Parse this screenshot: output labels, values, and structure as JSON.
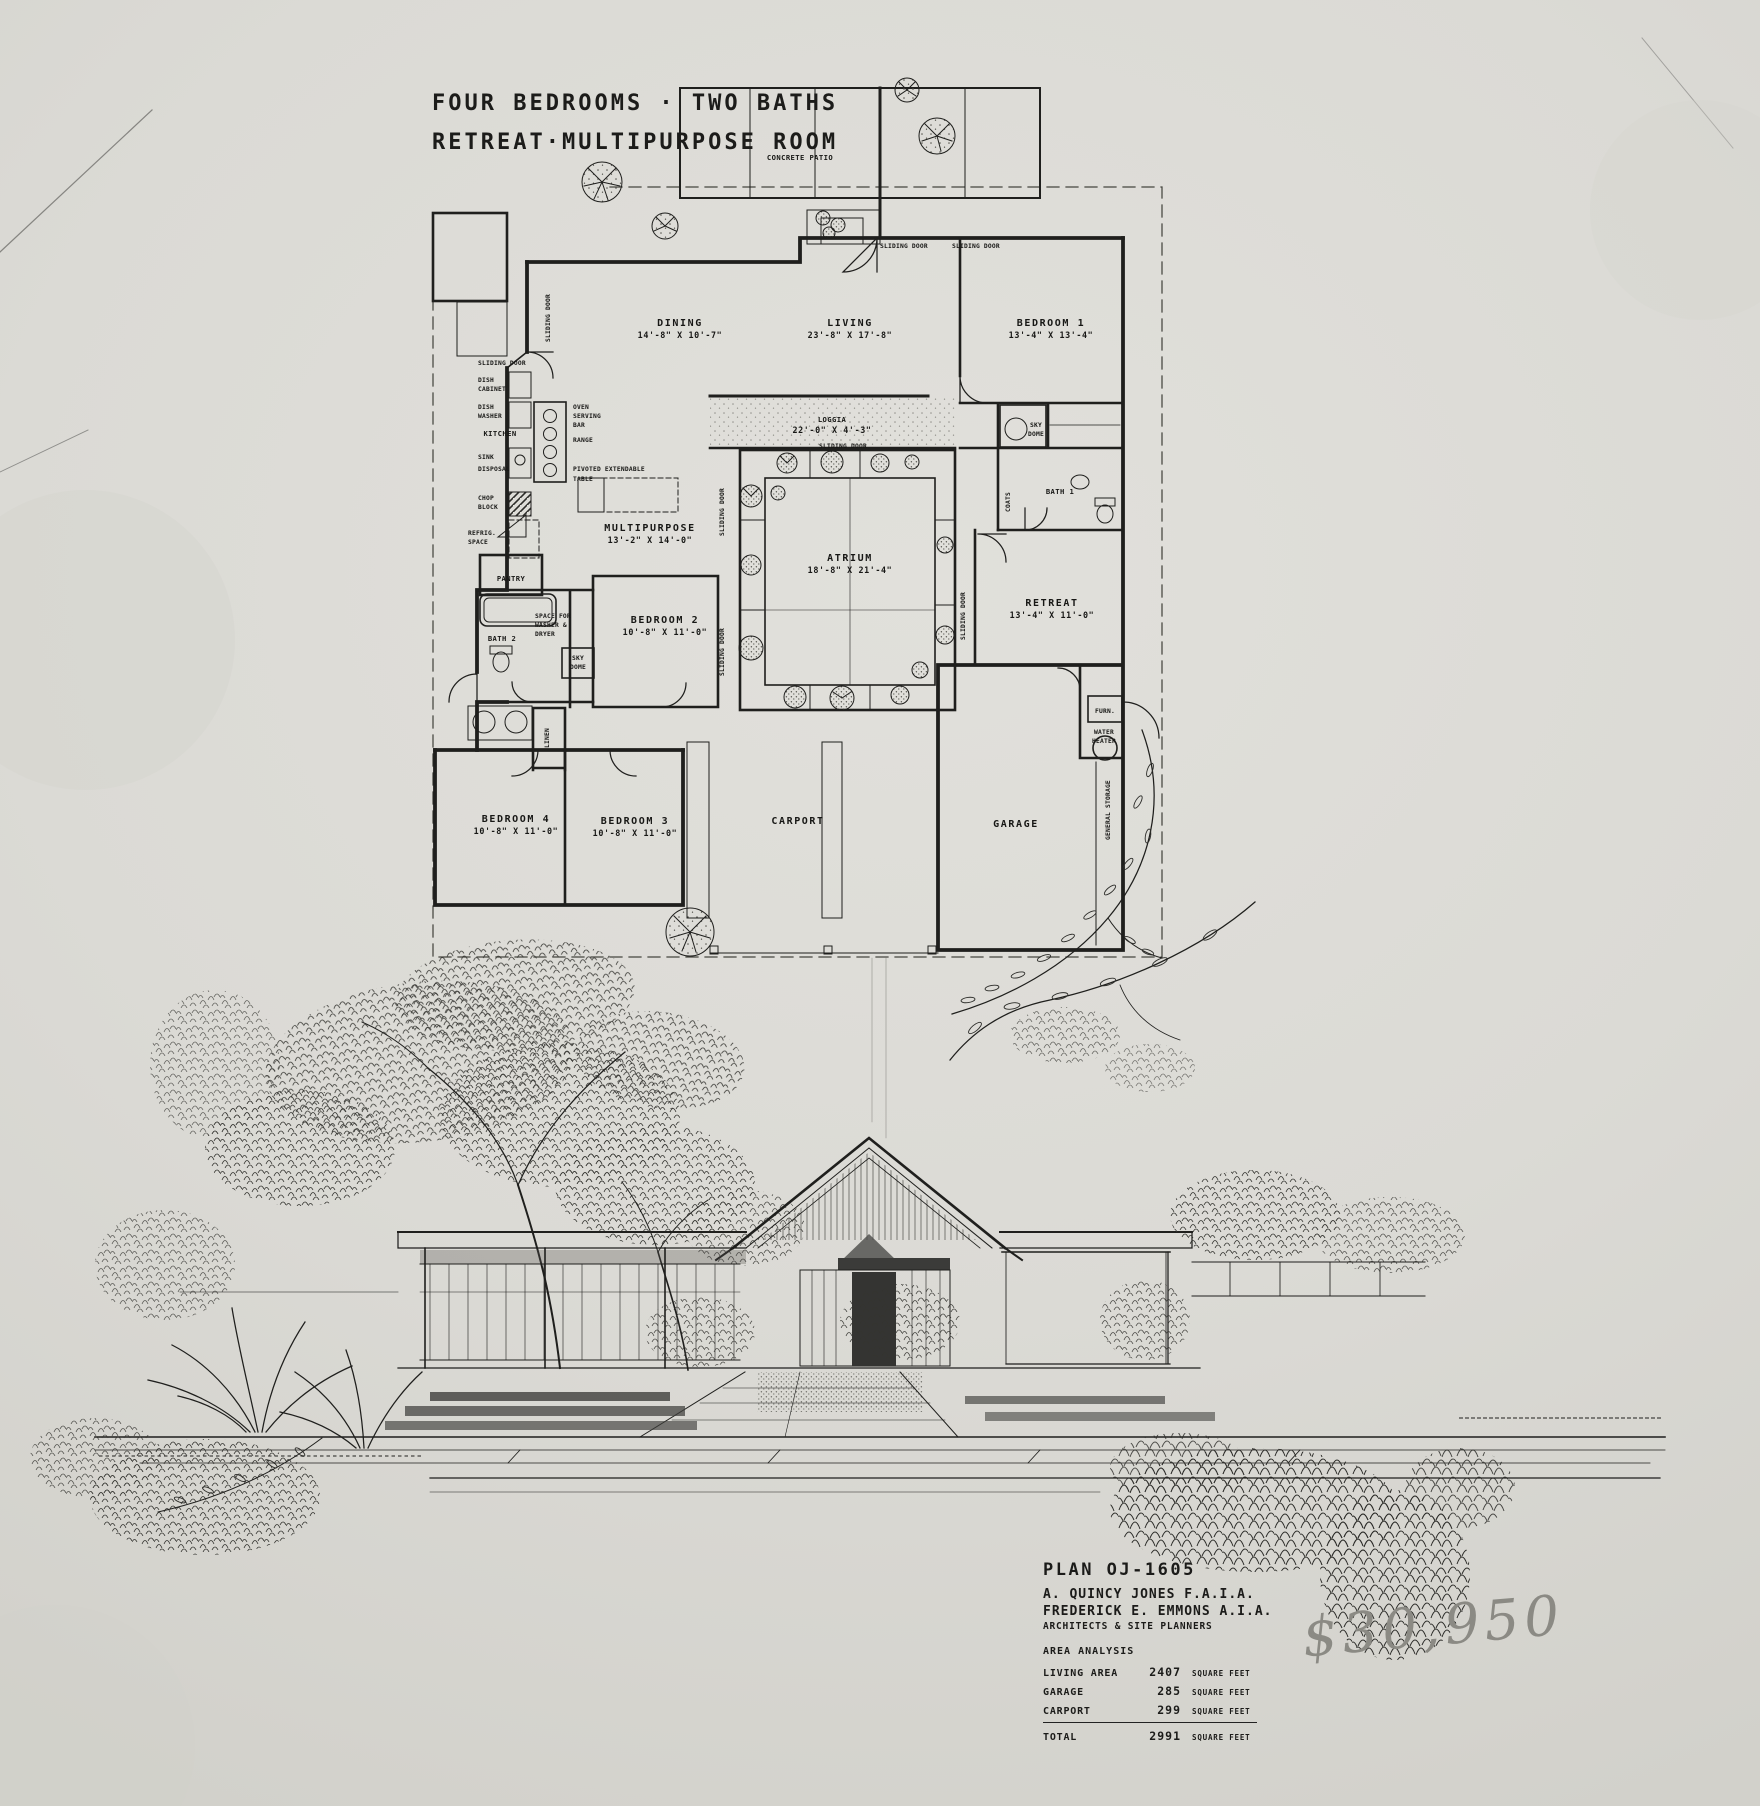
{
  "sheet": {
    "title_line1": "FOUR BEDROOMS · TWO BATHS",
    "title_line2": "RETREAT·MULTIPURPOSE ROOM",
    "handwritten_price": "$30,950",
    "paper_color": "#dbdad5",
    "ink_color": "#1f1f1d",
    "pencil_color": "#8b8a84"
  },
  "plan": {
    "patio_label": "CONCRETE PATIO",
    "rooms": {
      "dining": {
        "name": "DINING",
        "dims": "14'-8\" X 10'-7\""
      },
      "living": {
        "name": "LIVING",
        "dims": "23'-8\" X 17'-8\""
      },
      "bedroom1": {
        "name": "BEDROOM 1",
        "dims": "13'-4\" X 13'-4\""
      },
      "loggia": {
        "name": "LOGGIA",
        "dims": "22'-0\" X 4'-3\""
      },
      "multipurpose": {
        "name": "MULTIPURPOSE",
        "dims": "13'-2\" X 14'-0\""
      },
      "atrium": {
        "name": "ATRIUM",
        "dims": "18'-8\" X 21'-4\""
      },
      "retreat": {
        "name": "RETREAT",
        "dims": "13'-4\" X 11'-0\""
      },
      "bedroom2": {
        "name": "BEDROOM 2",
        "dims": "10'-8\" X 11'-0\""
      },
      "bedroom3": {
        "name": "BEDROOM 3",
        "dims": "10'-8\" X 11'-0\""
      },
      "bedroom4": {
        "name": "BEDROOM 4",
        "dims": "10'-8\" X 11'-0\""
      },
      "carport": {
        "name": "CARPORT"
      },
      "garage": {
        "name": "GARAGE"
      },
      "bath1": {
        "name": "BATH 1"
      },
      "bath2": {
        "name": "BATH 2"
      },
      "kitchen": {
        "name": "KITCHEN"
      }
    },
    "labels": {
      "sliding_door": "SLIDING DOOR",
      "dish_cabinet": [
        "DISH",
        "CABINET"
      ],
      "dish_washer": [
        "DISH",
        "WASHER"
      ],
      "sink": "SINK",
      "disposal": "DISPOSAL",
      "chop_block": [
        "CHOP",
        "BLOCK"
      ],
      "refrig_space": [
        "REFRIG.",
        "SPACE"
      ],
      "oven_serving_bar": [
        "OVEN",
        "SERVING",
        "BAR"
      ],
      "range": "RANGE",
      "pivoted_table": [
        "PIVOTED EXTENDABLE",
        "TABLE"
      ],
      "pantry": "PANTRY",
      "washer_dryer": [
        "SPACE FOR",
        "WASHER &",
        "DRYER"
      ],
      "sky_dome": [
        "SKY",
        "DOME"
      ],
      "linen": "LINEN",
      "coats": "COATS",
      "furnace": "FURN.",
      "water_heater": [
        "WATER",
        "HEATER"
      ],
      "general_storage": "GENERAL STORAGE"
    }
  },
  "title_block": {
    "plan_number": "PLAN OJ-1605",
    "architect_1": "A. QUINCY JONES  F.A.I.A.",
    "architect_2": "FREDERICK E. EMMONS  A.I.A.",
    "firm_role": "ARCHITECTS & SITE PLANNERS",
    "section_title": "AREA ANALYSIS",
    "rows": [
      {
        "label": "LIVING AREA",
        "value": "2407",
        "unit": "SQUARE FEET"
      },
      {
        "label": "GARAGE",
        "value": "285",
        "unit": "SQUARE FEET"
      },
      {
        "label": "CARPORT",
        "value": "299",
        "unit": "SQUARE FEET"
      }
    ],
    "total_row": {
      "label": "TOTAL",
      "value": "2991",
      "unit": "SQUARE FEET"
    }
  }
}
